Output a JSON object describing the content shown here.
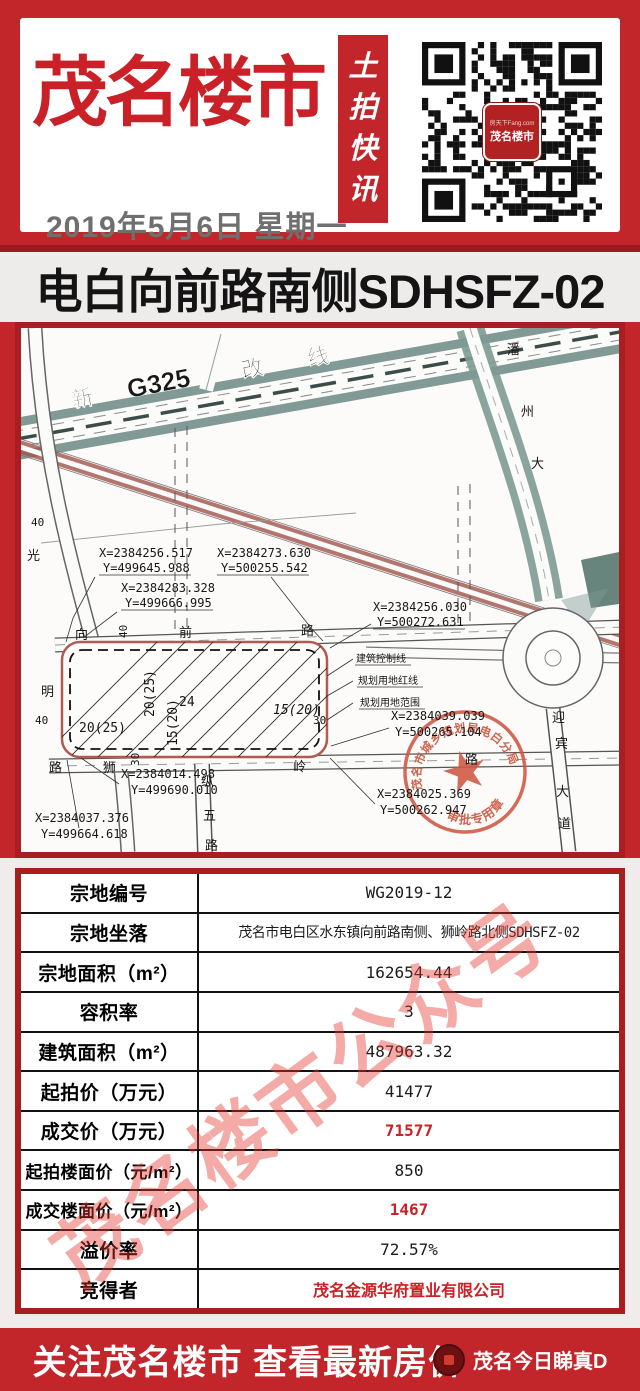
{
  "header": {
    "brand": "茂名楼市",
    "date": "2019年5月6日 星期一",
    "banner_vertical": [
      "土",
      "拍",
      "快",
      "讯"
    ],
    "qr_logo": {
      "line1": "房天下Fang.com",
      "line2": "茂名楼市"
    }
  },
  "headline": "电白向前路南侧SDHSFZ-02",
  "map": {
    "roads": {
      "g325": [
        "新",
        "G325",
        "改",
        "线"
      ],
      "xiangqian": [
        "向",
        "前",
        "路"
      ],
      "shiling": [
        "狮",
        "岭",
        "路"
      ],
      "zongwu": [
        "纵",
        "五",
        "路"
      ],
      "panzhou": [
        "潘",
        "州",
        "大"
      ],
      "yingbin": [
        "迎",
        "宾",
        "大",
        "道"
      ],
      "left_road": [
        "光",
        "明",
        "路"
      ]
    },
    "widths": [
      "40",
      "40",
      "40",
      "30",
      "30"
    ],
    "parcel_dims": [
      "20(25)",
      "24",
      "15(20)",
      "20(25)",
      "15(20)"
    ],
    "legend": [
      "建筑控制线",
      "规划用地红线",
      "规划用地范围"
    ],
    "coords": [
      {
        "x": "X=2384256.517",
        "y": "Y=499645.988"
      },
      {
        "x": "X=2384273.630",
        "y": "Y=500255.542"
      },
      {
        "x": "X=2384283.328",
        "y": "Y=499666.995"
      },
      {
        "x": "X=2384256.030",
        "y": "Y=500272.631"
      },
      {
        "x": "X=2384039.039",
        "y": "Y=500265.104"
      },
      {
        "x": "X=2384014.498",
        "y": "Y=499690.010"
      },
      {
        "x": "X=2384037.376",
        "y": "Y=499664.618"
      },
      {
        "x": "X=2384025.369",
        "y": "Y=500262.947"
      }
    ],
    "stamp": {
      "ring_text": "茂名市城乡规划局电白分局",
      "bottom_text": "审批专用章"
    }
  },
  "table": {
    "rows": [
      {
        "label": "宗地编号",
        "value": "WG2019-12"
      },
      {
        "label": "宗地坐落",
        "value": "茂名市电白区水东镇向前路南侧、狮岭路北侧SDHSFZ-02"
      },
      {
        "label": "宗地面积（m²）",
        "value": "162654.44"
      },
      {
        "label": "容积率",
        "value": "3"
      },
      {
        "label": "建筑面积（m²）",
        "value": "487963.32"
      },
      {
        "label": "起拍价（万元）",
        "value": "41477"
      },
      {
        "label": "成交价（万元）",
        "value": "71577"
      },
      {
        "label": "起拍楼面价（元/m²）",
        "value": "850"
      },
      {
        "label": "成交楼面价（元/m²）",
        "value": "1467"
      },
      {
        "label": "溢价率",
        "value": "72.57%"
      },
      {
        "label": "竞得者",
        "value": "茂名金源华府置业有限公司"
      }
    ]
  },
  "watermark": "茂名楼市公众号",
  "footer": {
    "main": "关注茂名楼市 查看最新房价",
    "sub": "茂名今日睇真D"
  }
}
